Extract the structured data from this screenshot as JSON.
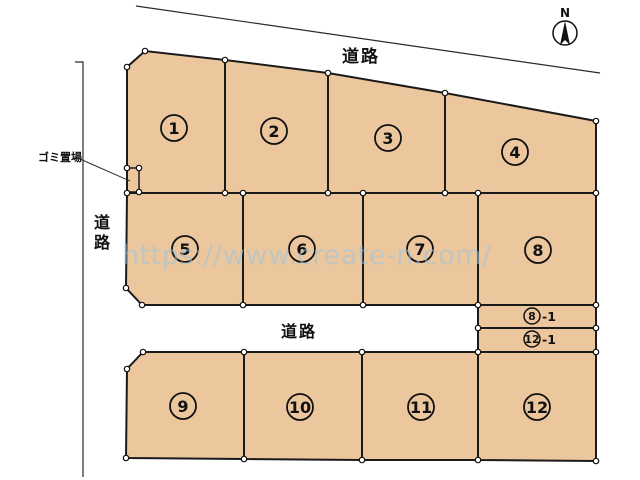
{
  "compass": {
    "label": "N"
  },
  "labels": {
    "road_top": "道路",
    "road_left": "道路",
    "road_middle": "道路",
    "garbage": "ゴミ置場"
  },
  "plots": [
    {
      "label": "1"
    },
    {
      "label": "2"
    },
    {
      "label": "3"
    },
    {
      "label": "4"
    },
    {
      "label": "5"
    },
    {
      "label": "6"
    },
    {
      "label": "7"
    },
    {
      "label": "8"
    },
    {
      "label": "9"
    },
    {
      "label": "10"
    },
    {
      "label": "11"
    },
    {
      "label": "12"
    }
  ],
  "strips": [
    {
      "number": "8",
      "suffix": "-1"
    },
    {
      "number": "12",
      "suffix": "-1"
    }
  ],
  "watermark": {
    "text": "https://www.create-n.com/"
  },
  "colors": {
    "plot_fill": "#ecc79e",
    "line": "#1a1a1a",
    "watermark": "#9cc2da",
    "background": "#ffffff"
  }
}
